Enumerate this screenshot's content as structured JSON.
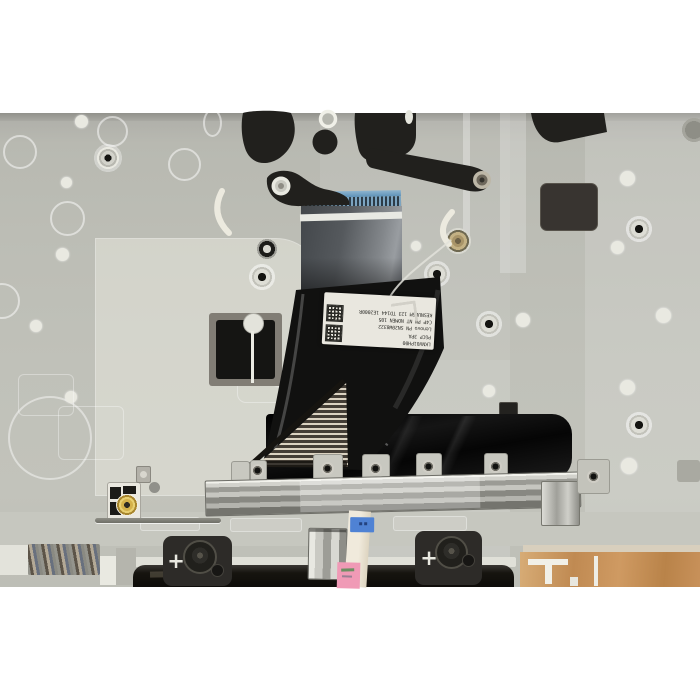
{
  "scene": {
    "type": "product-photo",
    "subject": "laptop palmrest internal side with keyboard flex ribbon cable",
    "background": "#ffffff"
  },
  "colors": {
    "panel": "#b8b9b1",
    "ribbon_stiffener_blue": "#6fa2c6",
    "glossy_ribbon_black": "#111110",
    "silver_bar": "#b4b4ae",
    "copper_pad": "#c08a52",
    "blue_tape": "#4f82d4",
    "pink_label": "#f09ab6",
    "bracket_black": "#2d2b28",
    "gold_connector": "#caa83e"
  },
  "ribbon_label": {
    "rotation": "upside-down",
    "qr_count": 2,
    "lines": [
      "LKNV01PH00",
      "PGCP 3PA",
      "Lenovo PN SN20W8322",
      "C4P PN NT NOMEN 105",
      "KESNUD6M 123 TD144 1E2000R"
    ]
  },
  "bottom_brackets": {
    "left_cross": "+",
    "right_cross": "+"
  }
}
